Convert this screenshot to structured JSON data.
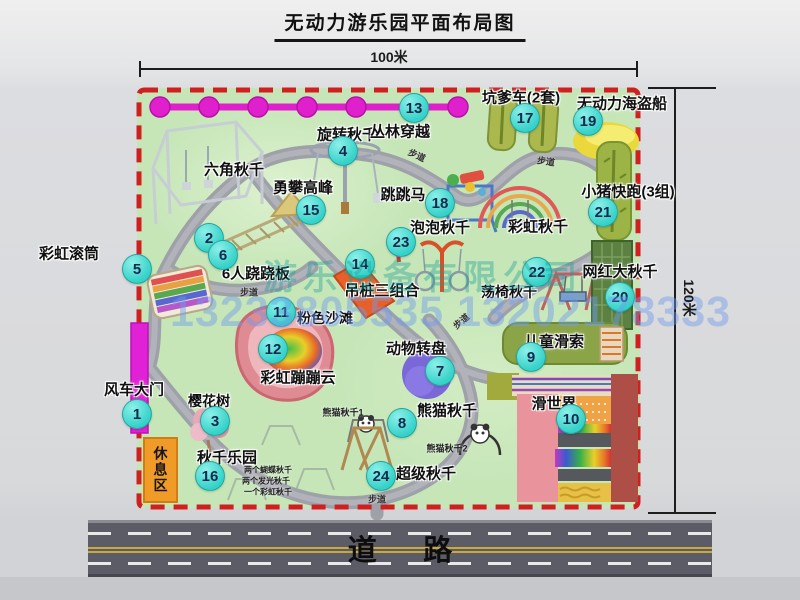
{
  "title": "无动力游乐园平面布局图",
  "dimensions": {
    "width_label": "100米",
    "height_label": "120米"
  },
  "watermark": {
    "company": "游乐设备有限公司",
    "phone": "13233805535 13202178333"
  },
  "road": {
    "label": "道路"
  },
  "rest_area": {
    "label": "休息区"
  },
  "colors": {
    "badge": "#35d2c9",
    "border_red": "#d01f1f",
    "park_green": "#c6e6b8",
    "gate_magenta": "#e121d6",
    "chain_magenta": "#e020cc",
    "road_gray": "#5c5c67",
    "rest_orange": "#f09a28",
    "path_gray": "#9fa1a9"
  },
  "map": {
    "items": [
      {
        "n": "1",
        "t": "风车大门",
        "bx": 137,
        "by": 414,
        "lx": 134,
        "ly": 389,
        "ls": 15
      },
      {
        "n": "2",
        "t": "六角秋千",
        "bx": 209,
        "by": 238,
        "lx": 234,
        "ly": 169,
        "ls": 15
      },
      {
        "n": "3",
        "t": "樱花树",
        "bx": 215,
        "by": 421,
        "lx": 209,
        "ly": 401,
        "ls": 14
      },
      {
        "n": "4",
        "t": "旋转秋千",
        "bx": 343,
        "by": 151,
        "lx": 347,
        "ly": 134,
        "ls": 15
      },
      {
        "n": "5",
        "t": "彩虹滚筒",
        "bx": 137,
        "by": 269,
        "lx": 69,
        "ly": 253,
        "ls": 15
      },
      {
        "n": "6",
        "t": "6人跷跷板",
        "bx": 223,
        "by": 255,
        "lx": 256,
        "ly": 273,
        "ls": 15
      },
      {
        "n": "7",
        "t": "动物转盘",
        "bx": 440,
        "by": 371,
        "lx": 416,
        "ly": 348,
        "ls": 15
      },
      {
        "n": "8",
        "t": "熊猫秋千",
        "bx": 402,
        "by": 423,
        "lx": 447,
        "ly": 410,
        "ls": 15
      },
      {
        "n": "9",
        "t": "儿童滑索",
        "bx": 531,
        "by": 357,
        "lx": 554,
        "ly": 341,
        "ls": 15
      },
      {
        "n": "10",
        "t": "滑世界",
        "bx": 571,
        "by": 419,
        "lx": 554,
        "ly": 403,
        "ls": 15
      },
      {
        "n": "11",
        "t": "粉色沙滩",
        "bx": 281,
        "by": 312,
        "lx": 325,
        "ly": 318,
        "ls": 14
      },
      {
        "n": "12",
        "t": "彩虹蹦蹦云",
        "bx": 273,
        "by": 349,
        "lx": 298,
        "ly": 377,
        "ls": 15
      },
      {
        "n": "13",
        "t": "丛林穿越",
        "bx": 414,
        "by": 108,
        "lx": 400,
        "ly": 131,
        "ls": 15
      },
      {
        "n": "14",
        "t": "吊桩三组合",
        "bx": 360,
        "by": 264,
        "lx": 382,
        "ly": 290,
        "ls": 15
      },
      {
        "n": "15",
        "t": "勇攀高峰",
        "bx": 311,
        "by": 210,
        "lx": 303,
        "ly": 187,
        "ls": 15
      },
      {
        "n": "16",
        "t": "秋千乐园",
        "bx": 210,
        "by": 476,
        "lx": 227,
        "ly": 457,
        "ls": 15
      },
      {
        "n": "17",
        "t": "坑爹车(2套)",
        "bx": 525,
        "by": 118,
        "lx": 521,
        "ly": 97,
        "ls": 15
      },
      {
        "n": "18",
        "t": "跳跳马",
        "bx": 440,
        "by": 203,
        "lx": 403,
        "ly": 194,
        "ls": 15
      },
      {
        "n": "19",
        "t": "无动力海盗船",
        "bx": 588,
        "by": 121,
        "lx": 622,
        "ly": 103,
        "ls": 15
      },
      {
        "n": "20",
        "t": "网红大秋千",
        "bx": 620,
        "by": 297,
        "lx": 620,
        "ly": 271,
        "ls": 15
      },
      {
        "n": "21",
        "t": "小猪快跑(3组)",
        "bx": 603,
        "by": 212,
        "lx": 628,
        "ly": 191,
        "ls": 15
      },
      {
        "n": "22",
        "t": "荡椅秋千",
        "bx": 537,
        "by": 272,
        "lx": 509,
        "ly": 292,
        "ls": 14
      },
      {
        "n": "23",
        "t": "泡泡秋千",
        "bx": 401,
        "by": 242,
        "lx": 440,
        "ly": 227,
        "ls": 15
      },
      {
        "n": "24",
        "t": "超级秋千",
        "bx": 381,
        "by": 476,
        "lx": 426,
        "ly": 473,
        "ls": 15
      },
      {
        "n": null,
        "t": "彩虹秋千",
        "lx": 538,
        "ly": 226,
        "ls": 15
      }
    ],
    "small_labels": [
      {
        "t": "熊猫秋千1",
        "x": 343,
        "y": 412,
        "s": 9
      },
      {
        "t": "熊猫秋千2",
        "x": 447,
        "y": 448,
        "s": 9
      },
      {
        "t": "两个蝴蝶秋千",
        "x": 268,
        "y": 470,
        "s": 8
      },
      {
        "t": "两个发光秋千",
        "x": 266,
        "y": 481,
        "s": 8
      },
      {
        "t": "一个彩虹秋千",
        "x": 268,
        "y": 492,
        "s": 8
      }
    ],
    "path_labels": [
      {
        "t": "步道",
        "x": 417,
        "y": 155,
        "r": 25
      },
      {
        "t": "步道",
        "x": 546,
        "y": 161,
        "r": 8
      },
      {
        "t": "步道",
        "x": 249,
        "y": 292,
        "r": 0
      },
      {
        "t": "步道",
        "x": 461,
        "y": 321,
        "r": -40
      },
      {
        "t": "步道",
        "x": 377,
        "y": 499,
        "r": 0
      }
    ]
  }
}
